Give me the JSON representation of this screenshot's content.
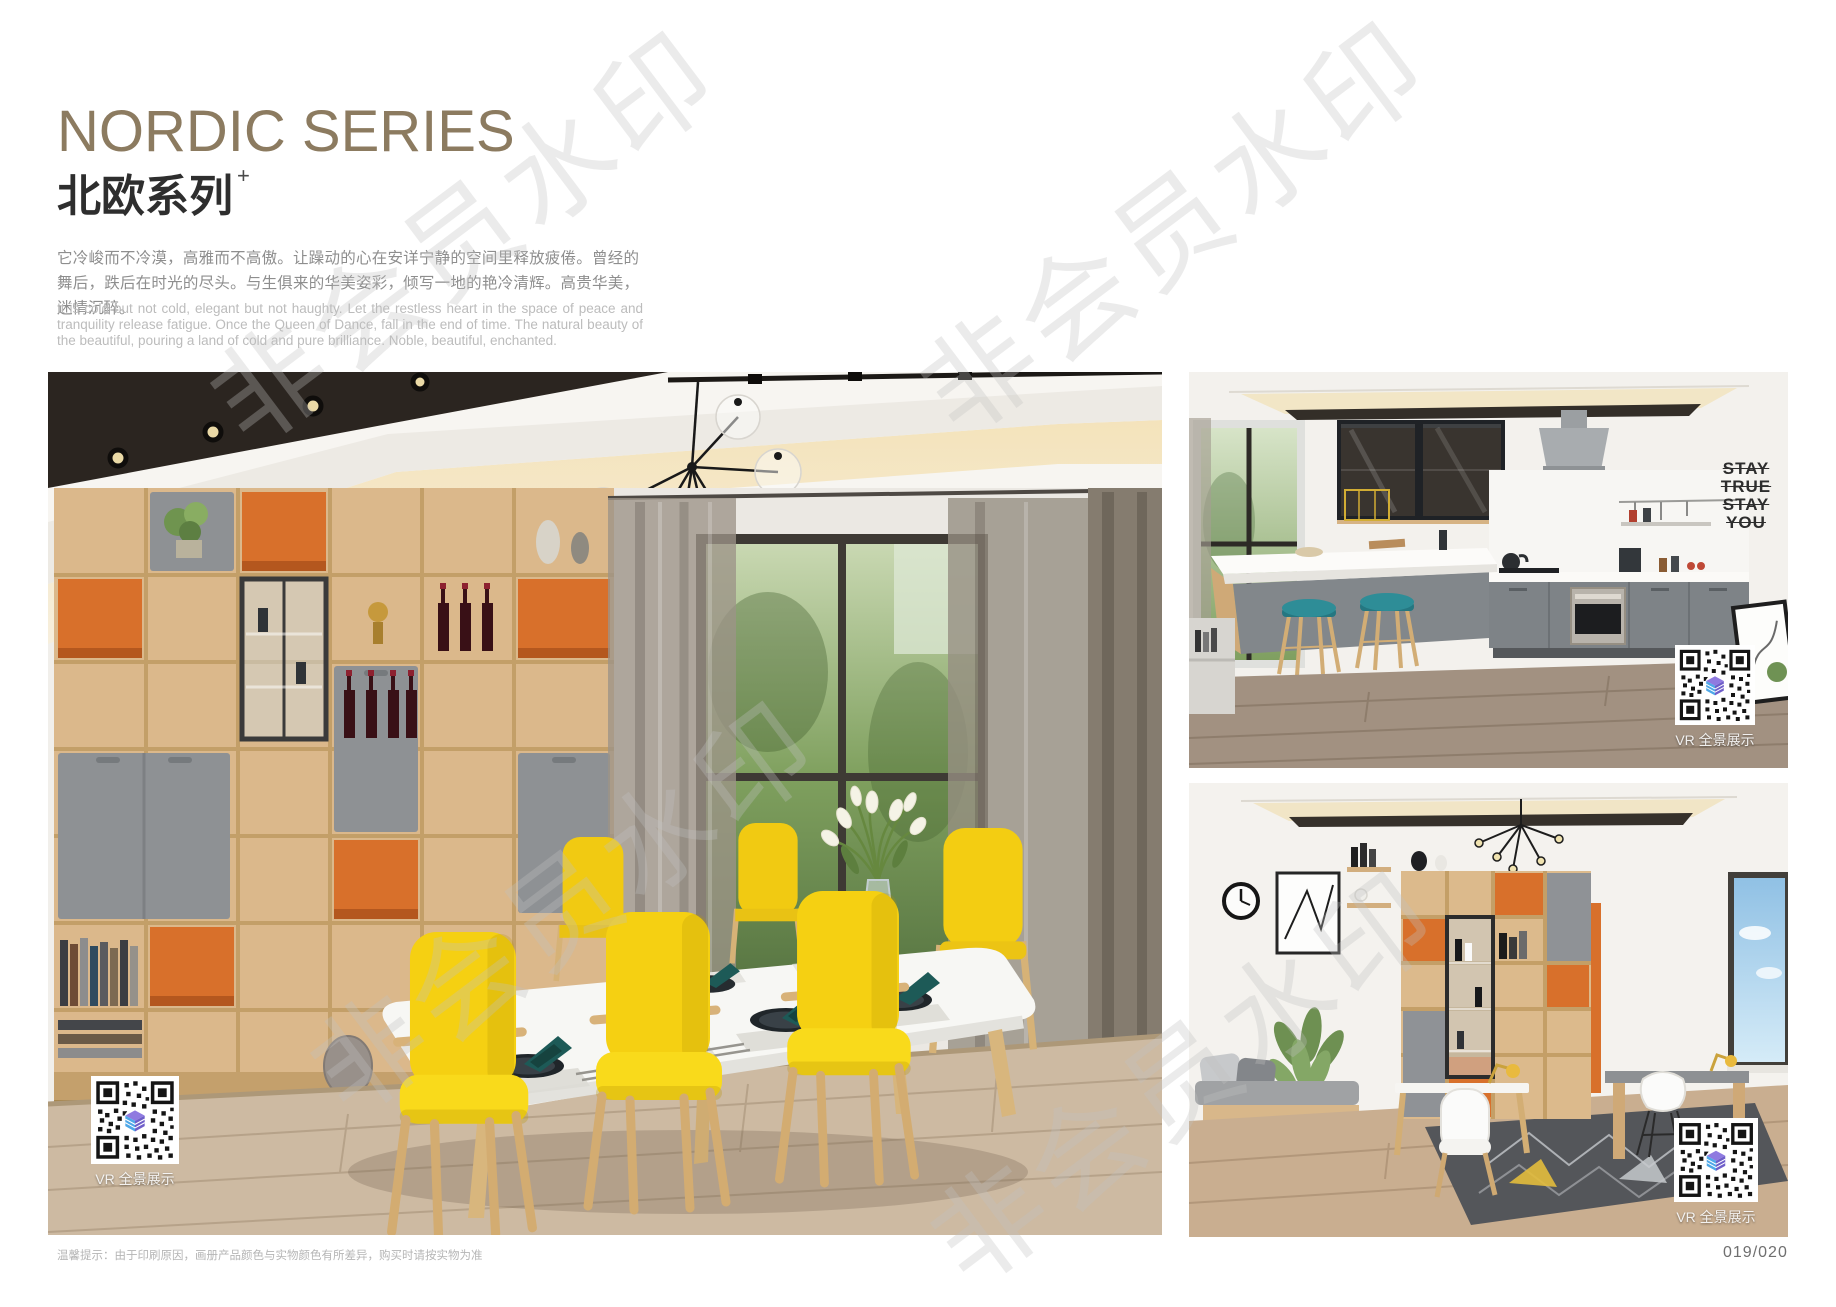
{
  "header": {
    "title_en": "NORDIC SERIES",
    "title_cn": "北欧系列",
    "title_sup": "+",
    "intro_cn": "它冷峻而不冷漠，高雅而不高傲。让躁动的心在安详宁静的空间里释放疲倦。曾经的舞后，跌后在时光的尽头。与生俱来的华美姿彩，倾写一地的艳冷清辉。高贵华美，迷情沉醉。",
    "intro_en": "It is cold but not cold, elegant but not haughty. Let the restless heart in the space of peace and tranquility release fatigue. Once the Queen of Dance, fall in the end of time. The natural beauty of the beautiful, pouring a land of cold and pure brilliance. Noble, beautiful, enchanted."
  },
  "watermark": {
    "text": "非会员水印"
  },
  "photos": {
    "dining": {
      "name": "nordic-dining-room",
      "vr_label": "VR 全景展示"
    },
    "kitchen": {
      "name": "nordic-kitchen",
      "vr_label": "VR 全景展示",
      "decal": {
        "lines": [
          "STAY",
          "TRUE",
          "STAY",
          "YOU"
        ]
      }
    },
    "study": {
      "name": "nordic-study-room",
      "vr_label": "VR 全景展示"
    }
  },
  "footer": {
    "disclaimer": "温馨提示：由于印刷原因，画册产品颜色与实物颜色有所差异，购买时请按实物为准",
    "page_number": "019/020"
  },
  "colors": {
    "title": "#8c7b60",
    "accent_orange": "#d8702b",
    "chair_yellow": "#f5d012",
    "napkin_teal": "#1d5a57",
    "stool_teal": "#2e8d97",
    "wood": "#dcba8c",
    "cabinet_gray": "#8f9296",
    "qr_logo_purple": "#7a63cf",
    "qr_logo_blue": "#4fa8e8"
  }
}
